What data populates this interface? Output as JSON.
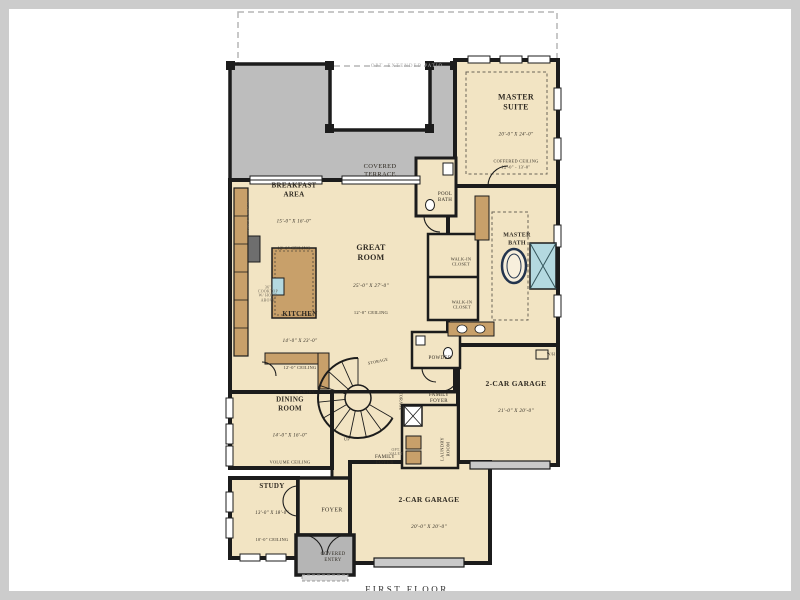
{
  "plan_title": "FIRST FLOOR",
  "colors": {
    "room_fill": "#f2e4c3",
    "terrace_fill": "#bdbdbd",
    "wall": "#1c1c1c",
    "cabinet_fill": "#c8a06a",
    "appliance_dark": "#6e6e6e",
    "shower_fill": "#b4d9e0",
    "frame": "#cccccc",
    "paper": "#ffffff"
  },
  "labels": {
    "opt_patio": {
      "note": "OPT. EXTENDED PATIO"
    },
    "covered_terrace": {
      "name": "COVERED\nTERRACE"
    },
    "master_suite": {
      "name": "MASTER\nSUITE",
      "dims": "20'-0\" X 24'-0\"",
      "ceiling": "COFFERED CEILING\n12'-0\" - 13'-0\""
    },
    "pool_bath": {
      "name": "POOL\nBATH"
    },
    "master_bath": {
      "name": "MASTER\nBATH"
    },
    "walk_in_closet_1": {
      "name": "WALK-IN\nCLOSET"
    },
    "walk_in_closet_2": {
      "name": "WALK-IN\nCLOSET"
    },
    "breakfast_area": {
      "name": "BREAKFAST\nAREA",
      "dims": "15'-0\" X 16'-0\"",
      "ceiling": "12'-0\" CEILING"
    },
    "great_room": {
      "name": "GREAT\nROOM",
      "dims": "25'-0\" X 27'-0\"",
      "ceiling": "12'-0\" CEILING"
    },
    "kitchen": {
      "name": "KITCHEN",
      "dims": "14'-0\" X 23'-0\"",
      "ceiling": "12'-0\" CEILING"
    },
    "cooktop_note": {
      "note": "36\"\nCOOKTOP\nW/ HOOD\nABOVE"
    },
    "upper_cabinets": {
      "note": "UPR. CABINETS"
    },
    "pantry": {
      "name": "PANTRY"
    },
    "dining_room": {
      "name": "DINING\nROOM",
      "dims": "14'-0\" X 16'-0\"",
      "ceiling": "VOLUME CEILING"
    },
    "storage_1": {
      "name": "STORAGE"
    },
    "storage_2": {
      "name": "STORAGE"
    },
    "up": {
      "name": "UP"
    },
    "opt_valet": {
      "note": "OPT.\nVALET"
    },
    "powder": {
      "name": "POWDER"
    },
    "family_foyer_1": {
      "name": "FAMILY\nFOYER"
    },
    "family_foyer_2": {
      "name": "FAMILY\nFOYER"
    },
    "laundry": {
      "name": "LAUNDRY\nROOM"
    },
    "water_heater": {
      "name": "W/H"
    },
    "garage_right": {
      "name": "2-CAR GARAGE",
      "dims": "21'-0\" X 20'-0\""
    },
    "garage_bottom": {
      "name": "2-CAR GARAGE",
      "dims": "20'-0\" X 20'-0\""
    },
    "study": {
      "name": "STUDY",
      "dims": "13'-0\" X 18'-0\"",
      "ceiling": "10'-0\" CEILING"
    },
    "foyer": {
      "name": "FOYER"
    },
    "covered_entry": {
      "name": "COVERED\nENTRY"
    },
    "first_floor": {
      "name": "FIRST FLOOR"
    }
  }
}
